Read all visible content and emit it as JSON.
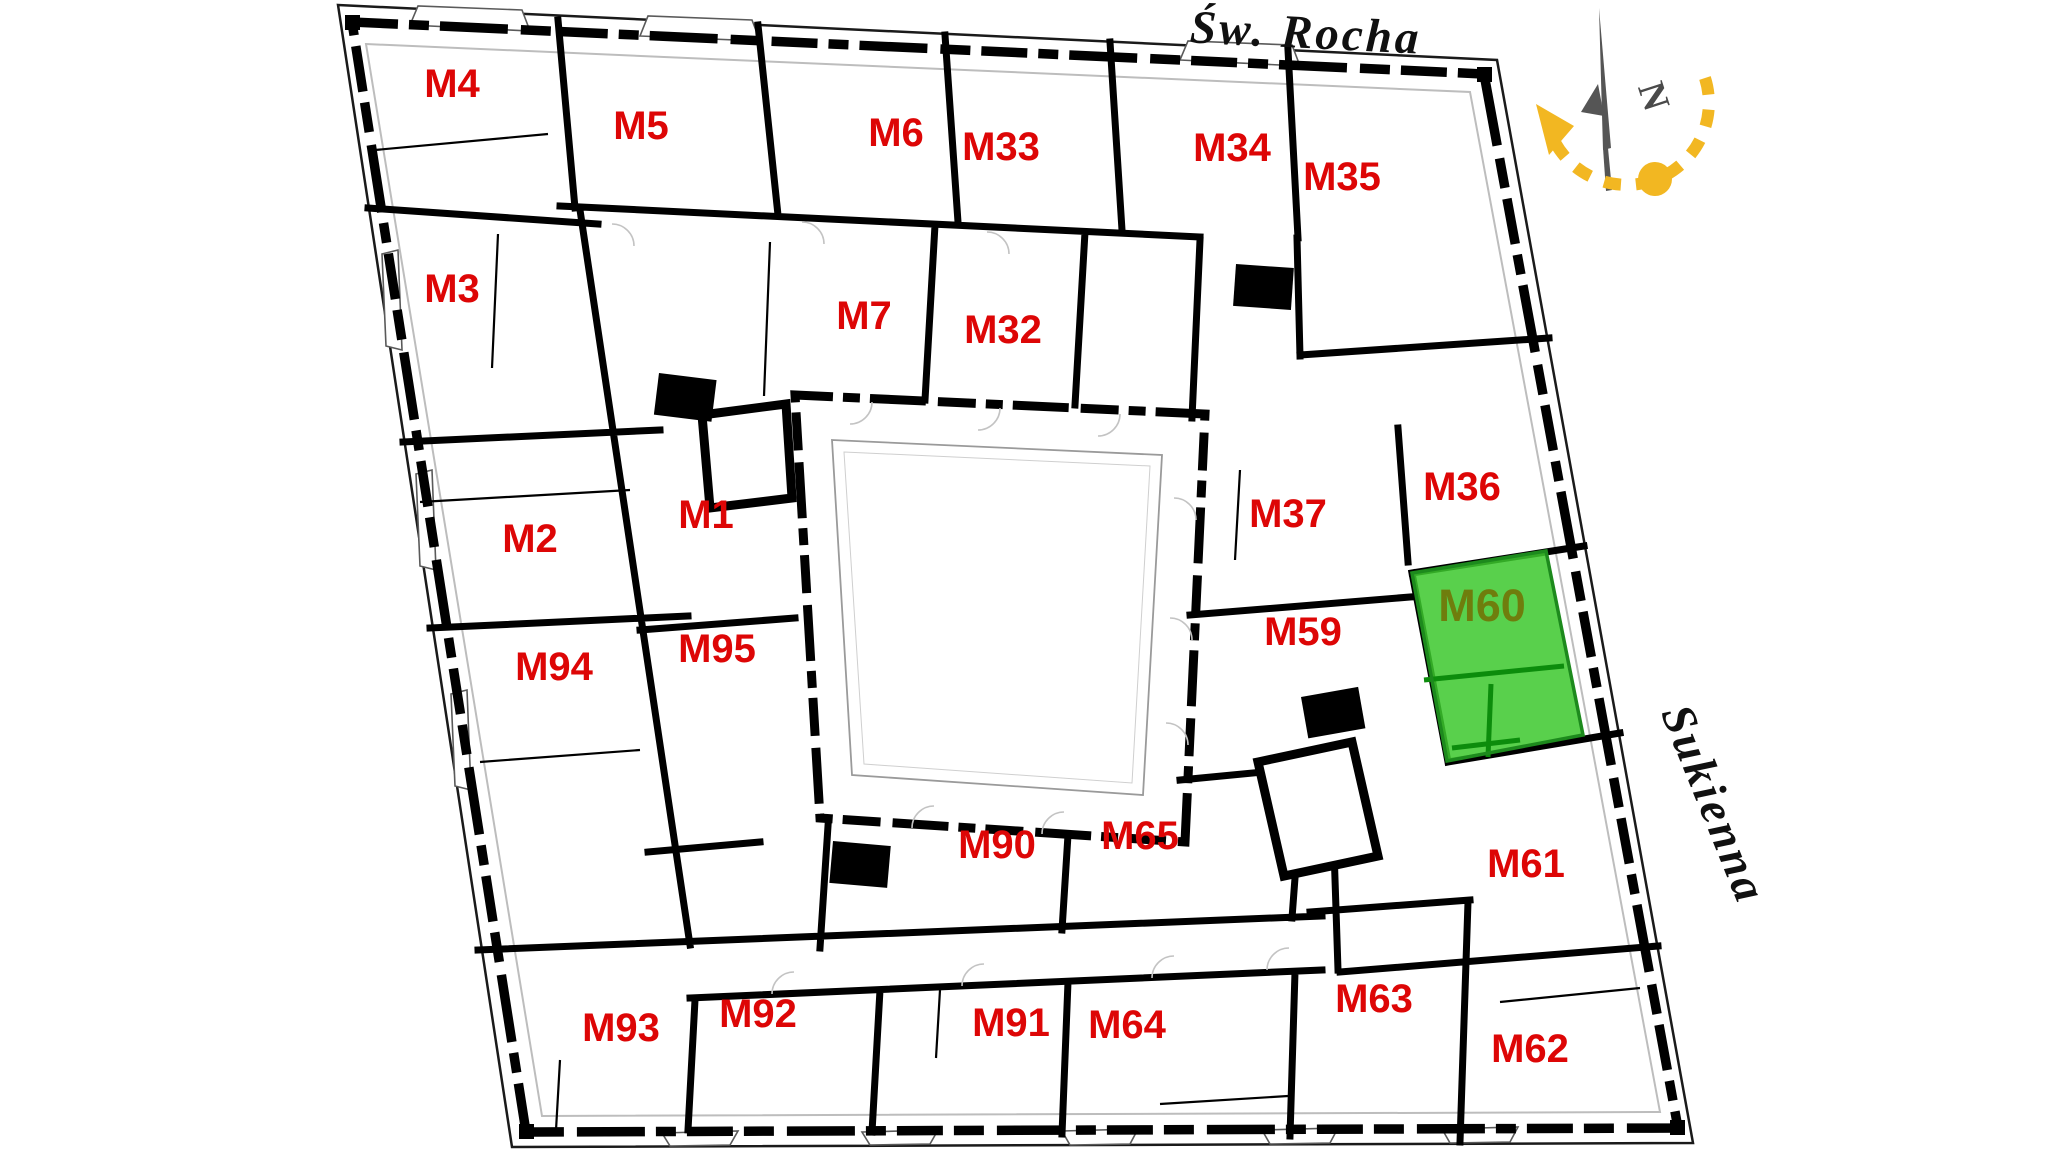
{
  "plan": {
    "streets": [
      {
        "id": "street-top",
        "text": "Św. Rocha"
      },
      {
        "id": "street-right",
        "text": "Sukienna"
      }
    ],
    "units": [
      {
        "id": "M4",
        "x": 452,
        "y": 97
      },
      {
        "id": "M5",
        "x": 641,
        "y": 139
      },
      {
        "id": "M6",
        "x": 896,
        "y": 146
      },
      {
        "id": "M33",
        "x": 1001,
        "y": 160
      },
      {
        "id": "M34",
        "x": 1232,
        "y": 161
      },
      {
        "id": "M35",
        "x": 1342,
        "y": 190
      },
      {
        "id": "M3",
        "x": 452,
        "y": 302
      },
      {
        "id": "M7",
        "x": 864,
        "y": 329
      },
      {
        "id": "M32",
        "x": 1003,
        "y": 343
      },
      {
        "id": "M36",
        "x": 1462,
        "y": 500
      },
      {
        "id": "M37",
        "x": 1288,
        "y": 527
      },
      {
        "id": "M2",
        "x": 530,
        "y": 552
      },
      {
        "id": "M1",
        "x": 706,
        "y": 528
      },
      {
        "id": "M60",
        "x": 1482,
        "y": 621,
        "selected": true
      },
      {
        "id": "M59",
        "x": 1303,
        "y": 645
      },
      {
        "id": "M94",
        "x": 554,
        "y": 680
      },
      {
        "id": "M95",
        "x": 717,
        "y": 662
      },
      {
        "id": "M90",
        "x": 997,
        "y": 858
      },
      {
        "id": "M65",
        "x": 1140,
        "y": 849
      },
      {
        "id": "M61",
        "x": 1526,
        "y": 877
      },
      {
        "id": "M93",
        "x": 621,
        "y": 1041
      },
      {
        "id": "M92",
        "x": 758,
        "y": 1027
      },
      {
        "id": "M91",
        "x": 1011,
        "y": 1036
      },
      {
        "id": "M64",
        "x": 1127,
        "y": 1038
      },
      {
        "id": "M63",
        "x": 1374,
        "y": 1012
      },
      {
        "id": "M62",
        "x": 1530,
        "y": 1062
      }
    ],
    "selected_unit": "M60",
    "colors": {
      "unit_label": "#dd0606",
      "selected_label": "#6f7d0d",
      "selected_fill": "#3cc82d",
      "selected_wall": "#0c8c0c",
      "selected_stroke": "#1d8a1d",
      "compass_accent": "#f2b722",
      "compass_needle": "#555555"
    },
    "compass": {
      "north_letter": "N"
    }
  }
}
